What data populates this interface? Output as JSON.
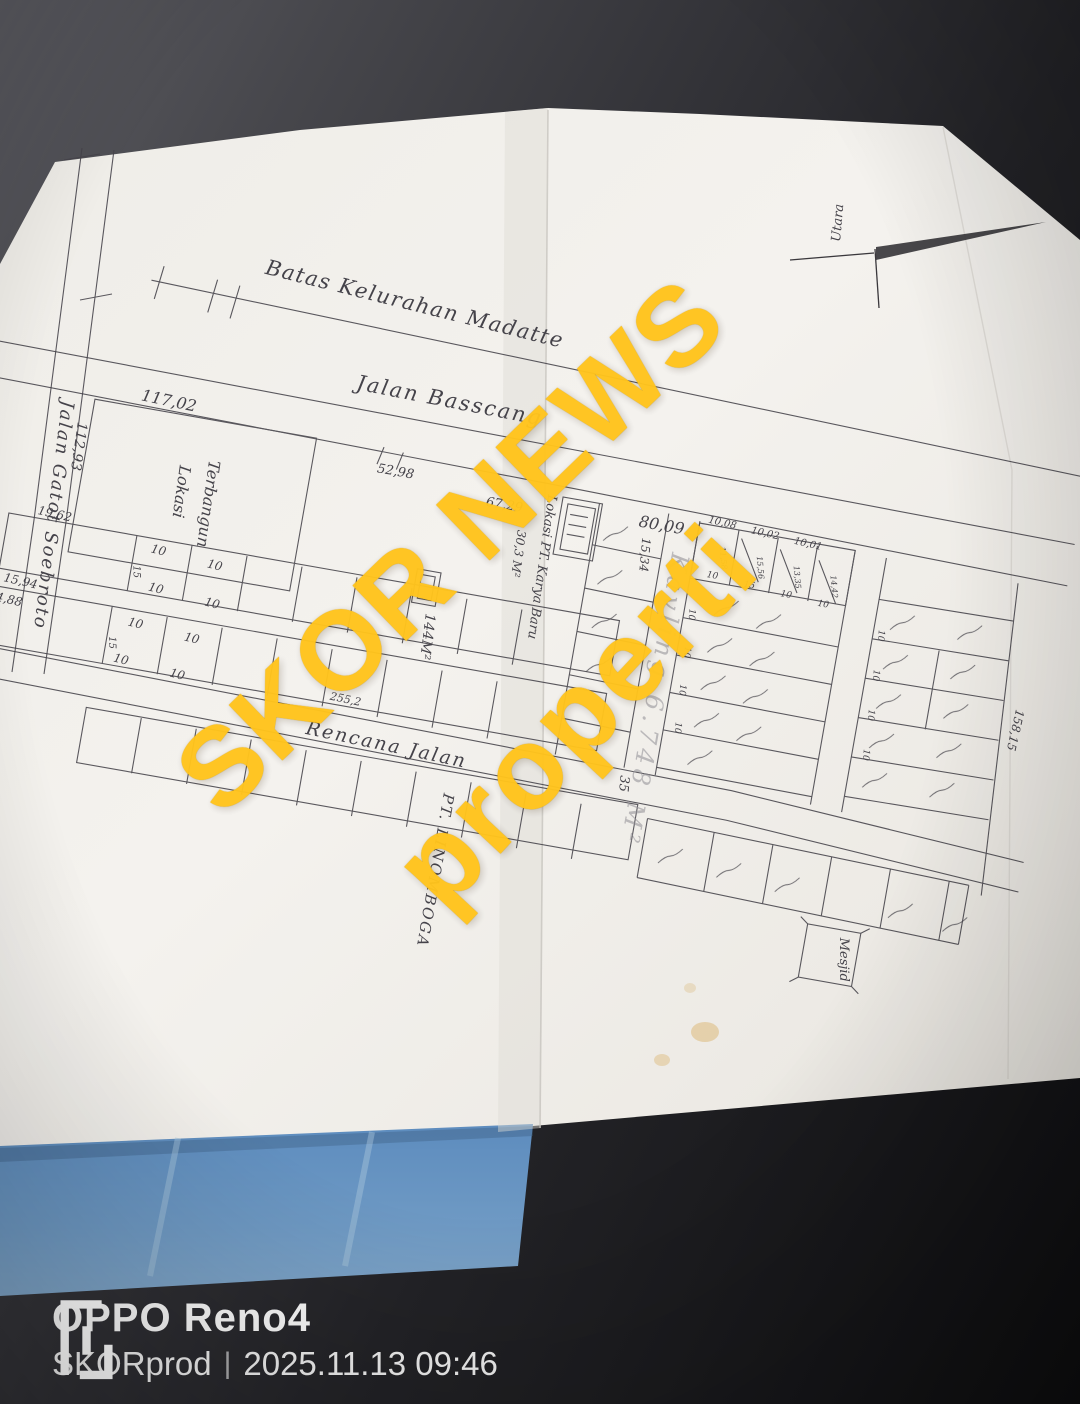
{
  "scene": {
    "table_color": "#2a2a2e",
    "paper_color": "#f2f0eb",
    "blue_sheet_color": "#6590bf",
    "ink_color": "#45434a",
    "watermark_color": "#ffc41c"
  },
  "watermark": {
    "line1": "SKOR NEWS",
    "line2": "properti"
  },
  "camera_stamp": {
    "device": "OPPO Reno4",
    "author": "SKORprod",
    "separator": "|",
    "timestamp": "2025.11.13 09:46"
  },
  "plan": {
    "north_label": "Utara",
    "boundary_label": "Batas Kelurahan Madatte",
    "roads": {
      "main": "Jalan Basscang",
      "left": "Jalan Gatot Soebroto",
      "planned": "Rencana Jalan"
    },
    "parcels": {
      "built_line1": "Lokasi",
      "built_line2": "Terbangun",
      "company_mid": "Lokasi PT. Karya Baru",
      "company_mid_area": "30,3 M²",
      "company_bottom": "PT. LINOMBOGA",
      "kavling_area": "Kavling 6.748 M²",
      "mosque": "Mesjid",
      "small_area": "144M²"
    },
    "dimensions": {
      "d117_02": "117,02",
      "d112_93": "112,93",
      "d52_98": "52,98",
      "d67_29": "67,29",
      "d80_09": "80,09",
      "d19_62": "19,62",
      "d15_94": "15,94",
      "d14_88": "14,88",
      "d11_2": "11,2",
      "d255_2": "255,2",
      "d158_15": "158,15",
      "d15_34": "15,34",
      "d35": "35",
      "w10": "10",
      "w15": "15",
      "top_widths": [
        "10,08",
        "10,02",
        "10,01"
      ],
      "strip_depths": [
        "11,58",
        "15,56",
        "13,35",
        "14,42"
      ]
    }
  }
}
